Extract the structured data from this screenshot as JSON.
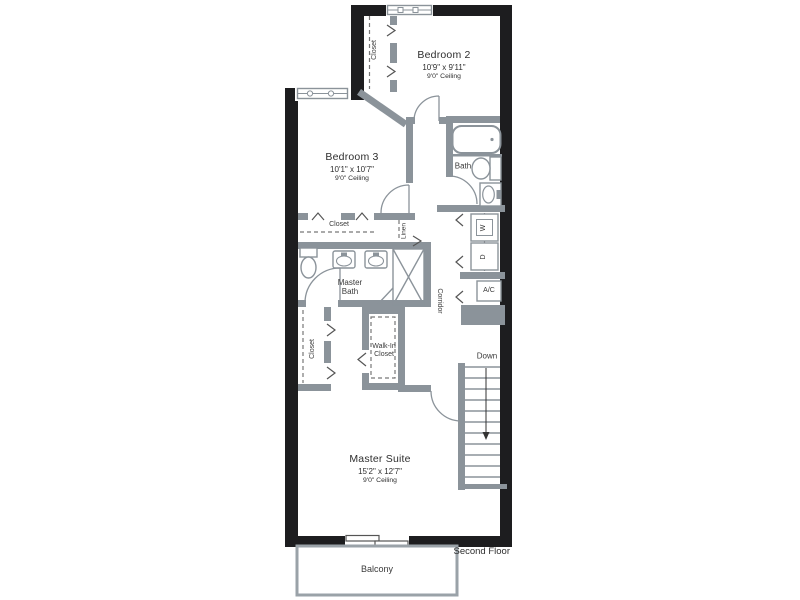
{
  "colors": {
    "exterior_wall": "#1d1d1f",
    "interior_wall": "#8b939a",
    "balcony_outline": "#9aa2a8",
    "label_text": "#3a3a3a"
  },
  "plan": {
    "floor_label": "Second Floor",
    "balcony_label": "Balcony",
    "corridor_label": "Corridor",
    "down_label": "Down",
    "linen_label": "Linen",
    "closet_label": "Closet",
    "washer_label": "W",
    "dryer_label": "D",
    "ac_label": "A/C",
    "bath_label": "Bath",
    "master_bath_label": "Master Bath",
    "walk_in_closet_label": "Walk-In Closet",
    "rooms": {
      "bedroom2": {
        "name": "Bedroom 2",
        "dimensions": "10'9\" x 9'11\"",
        "ceiling": "9'0\" Ceiling"
      },
      "bedroom3": {
        "name": "Bedroom 3",
        "dimensions": "10'1\" x 10'7\"",
        "ceiling": "9'0\" Ceiling"
      },
      "master_suite": {
        "name": "Master Suite",
        "dimensions": "15'2\" x 12'7\"",
        "ceiling": "9'0\" Ceiling"
      }
    }
  }
}
